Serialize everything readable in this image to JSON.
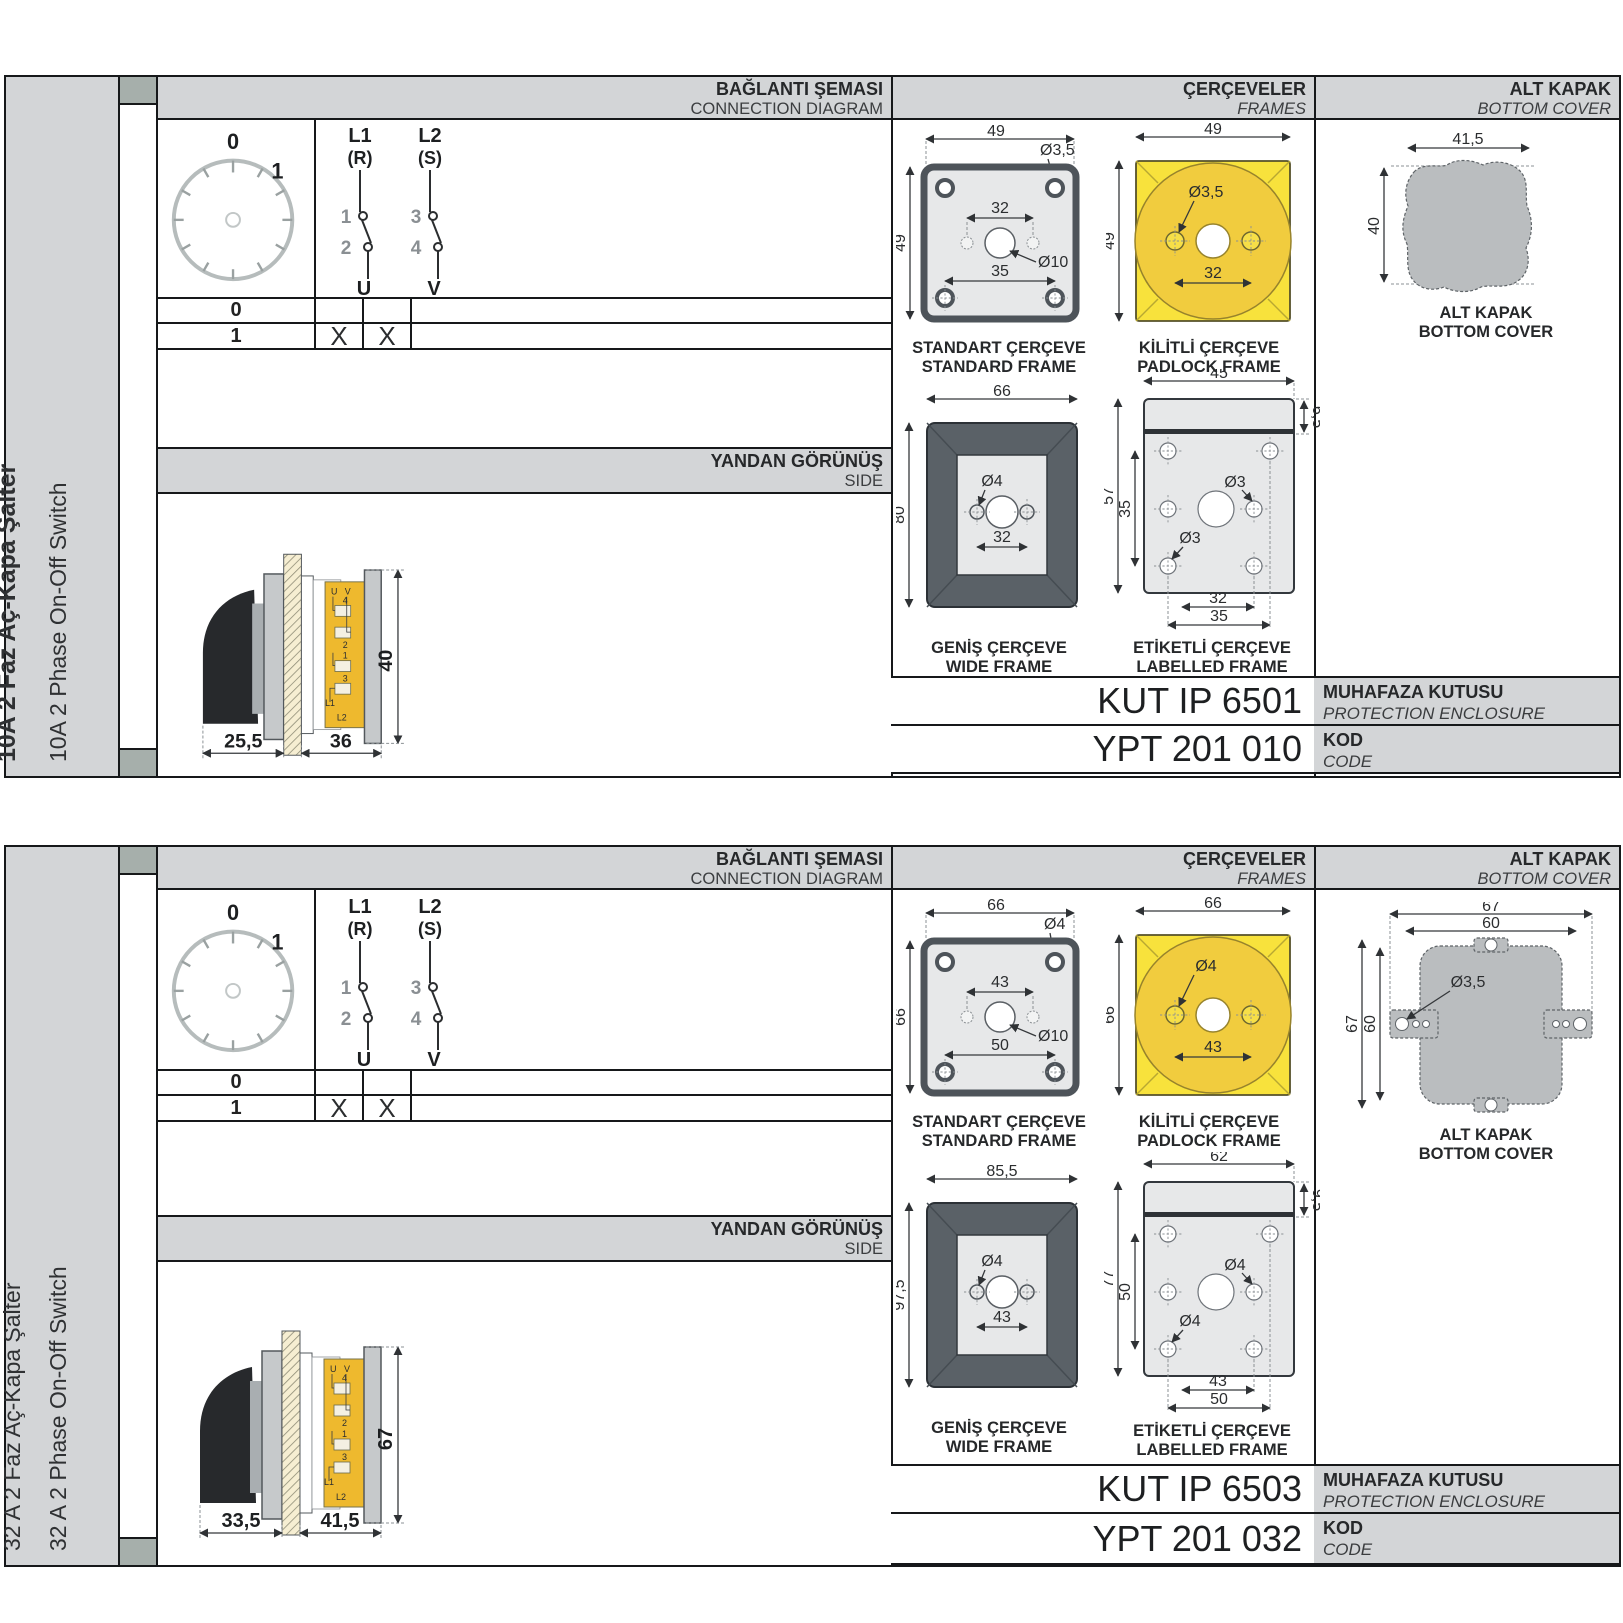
{
  "sections": [
    {
      "sidebar": {
        "title": "10A 2 Faz Aç-Kapa Şalter",
        "subtitle": "10A 2 Phase On-Off Switch"
      },
      "headers": {
        "connection_tr": "BAĞLANTI ŞEMASI",
        "connection_en": "CONNECTION DIAGRAM",
        "frames_tr": "ÇERÇEVELER",
        "frames_en": "FRAMES",
        "cover_tr": "ALT KAPAK",
        "cover_en": "BOTTOM COVER",
        "side_tr": "YANDAN GÖRÜNÜŞ",
        "side_en": "SIDE"
      },
      "diagram": {
        "pos0": "0",
        "pos1": "1",
        "l1": "L1",
        "r": "(R)",
        "l2": "L2",
        "s": "(S)",
        "n1": "1",
        "n2": "2",
        "n3": "3",
        "n4": "4",
        "u": "U",
        "v": "V"
      },
      "table": {
        "row0": {
          "label": "0",
          "u": "",
          "v": ""
        },
        "row1": {
          "label": "1",
          "u": "X",
          "v": "X"
        }
      },
      "side_view": {
        "dim_front": "25,5",
        "dim_back": "36",
        "dim_height": "40",
        "terminals": {
          "u": "U",
          "v": "V",
          "t4": "4",
          "t2": "2",
          "t1": "1",
          "t3": "3",
          "l1": "L1",
          "l2": "L2"
        }
      },
      "frames": {
        "standard": {
          "tr": "STANDART ÇERÇEVE",
          "en": "STANDARD FRAME",
          "width": "49",
          "height": "49",
          "hole": "Ø3,5",
          "center": "Ø10",
          "inner": "32",
          "bottom": "35"
        },
        "padlock": {
          "tr": "KİLİTLİ ÇERÇEVE",
          "en": "PADLOCK FRAME",
          "width": "49",
          "height": "49",
          "hole": "Ø3,5",
          "inner": "32"
        },
        "wide": {
          "tr": "GENİŞ ÇERÇEVE",
          "en": "WIDE FRAME",
          "width": "66",
          "height": "80",
          "hole": "Ø4",
          "inner": "32"
        },
        "labelled": {
          "tr": "ETİKETLİ ÇERÇEVE",
          "en": "LABELLED FRAME",
          "width": "45",
          "top": "6,5",
          "height": "57",
          "holes_span": "35",
          "hole_right": "Ø3",
          "hole_left": "Ø3",
          "b_inner": "32",
          "b_outer": "35"
        }
      },
      "cover": {
        "tr": "ALT KAPAK",
        "en": "BOTTOM COVER",
        "width": "41,5",
        "height": "40"
      },
      "codes": {
        "enclosure_value": "KUT IP 6501",
        "enclosure_tr": "MUHAFAZA KUTUSU",
        "enclosure_en": "PROTECTION ENCLOSURE",
        "code_value": "YPT 201 010",
        "code_tr": "KOD",
        "code_en": "CODE"
      }
    },
    {
      "sidebar": {
        "title": "32 A 2 Faz Aç-Kapa Şalter",
        "subtitle": "32 A 2 Phase On-Off Switch"
      },
      "headers": {
        "connection_tr": "BAĞLANTI ŞEMASI",
        "connection_en": "CONNECTION DIAGRAM",
        "frames_tr": "ÇERÇEVELER",
        "frames_en": "FRAMES",
        "cover_tr": "ALT KAPAK",
        "cover_en": "BOTTOM COVER",
        "side_tr": "YANDAN GÖRÜNÜŞ",
        "side_en": "SIDE"
      },
      "diagram": {
        "pos0": "0",
        "pos1": "1",
        "l1": "L1",
        "r": "(R)",
        "l2": "L2",
        "s": "(S)",
        "n1": "1",
        "n2": "2",
        "n3": "3",
        "n4": "4",
        "u": "U",
        "v": "V"
      },
      "table": {
        "row0": {
          "label": "0",
          "u": "",
          "v": ""
        },
        "row1": {
          "label": "1",
          "u": "X",
          "v": "X"
        }
      },
      "side_view": {
        "dim_front": "33,5",
        "dim_back": "41,5",
        "dim_height": "67",
        "terminals": {
          "u": "U",
          "v": "V",
          "t4": "4",
          "t2": "2",
          "t1": "1",
          "t3": "3",
          "l1": "L1",
          "l2": "L2"
        }
      },
      "frames": {
        "standard": {
          "tr": "STANDART ÇERÇEVE",
          "en": "STANDARD FRAME",
          "width": "66",
          "height": "66",
          "hole": "Ø4",
          "center": "Ø10",
          "inner": "43",
          "bottom": "50"
        },
        "padlock": {
          "tr": "KİLİTLİ ÇERÇEVE",
          "en": "PADLOCK FRAME",
          "width": "66",
          "height": "66",
          "hole": "Ø4",
          "inner": "43"
        },
        "wide": {
          "tr": "GENİŞ ÇERÇEVE",
          "en": "WIDE FRAME",
          "width": "85,5",
          "height": "97,5",
          "hole": "Ø4",
          "inner": "43"
        },
        "labelled": {
          "tr": "ETİKETLİ ÇERÇEVE",
          "en": "LABELLED FRAME",
          "width": "62",
          "top": "9,5",
          "height": "77",
          "holes_span": "50",
          "hole_right": "Ø4",
          "hole_left": "Ø4",
          "b_inner": "43",
          "b_outer": "50"
        }
      },
      "cover": {
        "tr": "ALT KAPAK",
        "en": "BOTTOM COVER",
        "width_outer": "67",
        "width_inner": "60",
        "height_outer": "67",
        "height_inner": "60",
        "hole": "Ø3,5"
      },
      "codes": {
        "enclosure_value": "KUT IP 6503",
        "enclosure_tr": "MUHAFAZA KUTUSU",
        "enclosure_en": "PROTECTION ENCLOSURE",
        "code_value": "YPT 201 032",
        "code_tr": "KOD",
        "code_en": "CODE"
      }
    }
  ]
}
